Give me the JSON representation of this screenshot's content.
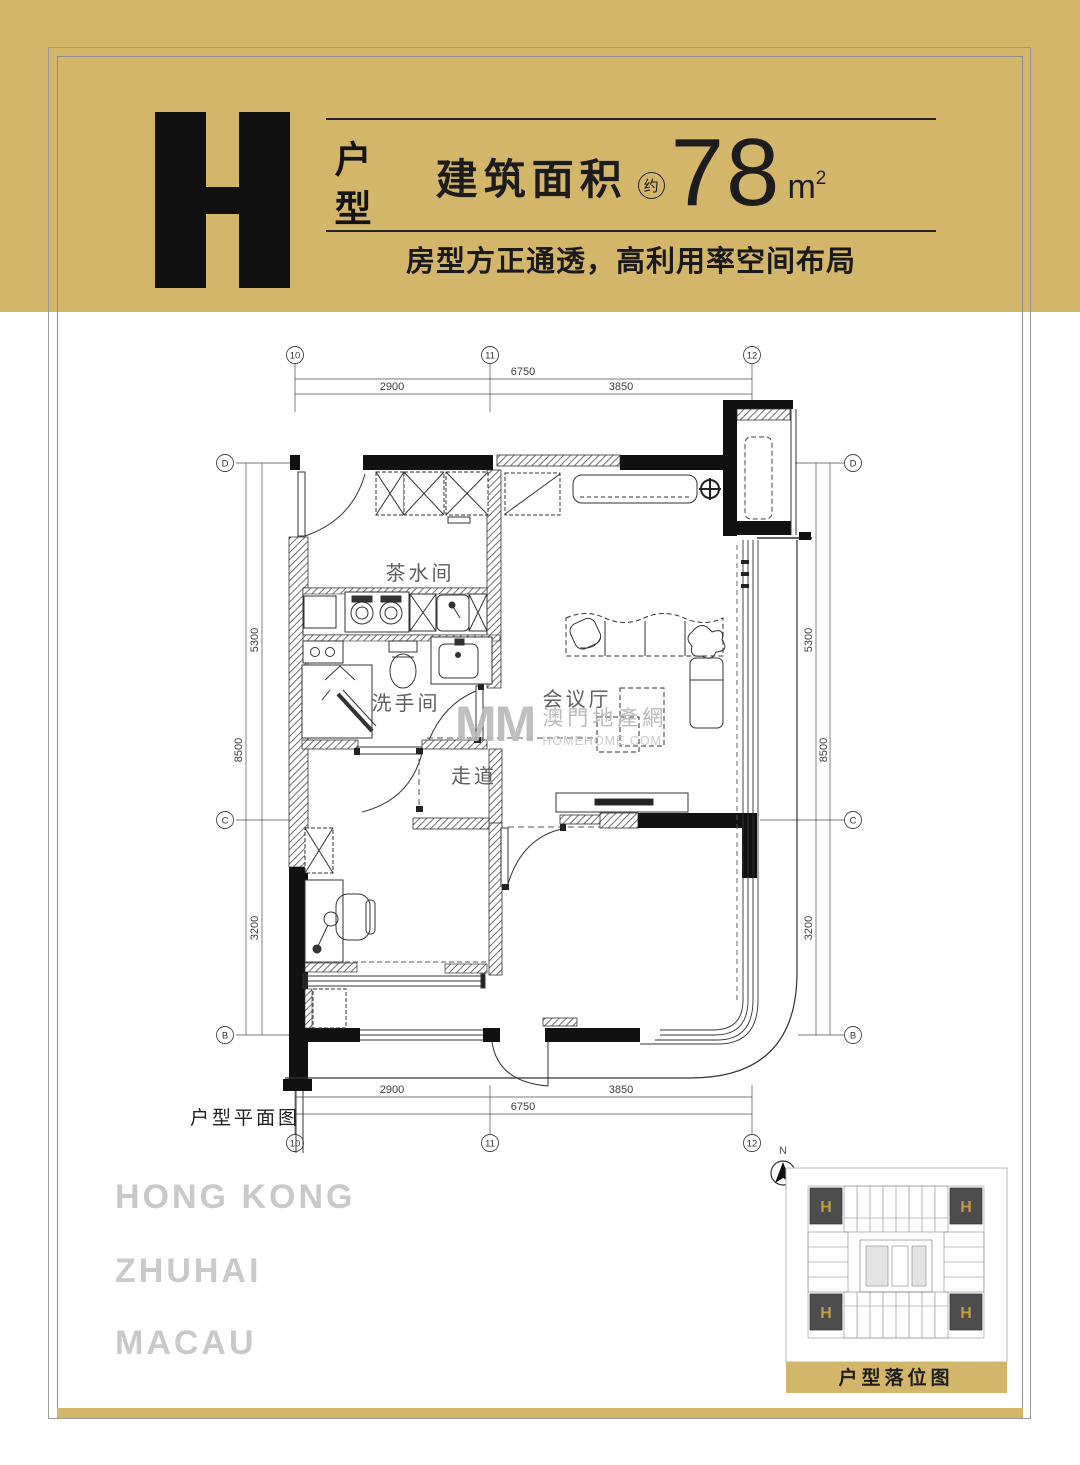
{
  "colors": {
    "gold": "#d3b66a",
    "ink": "#111111",
    "city_gray": "#c9c9c9",
    "watermark_gray": "#b9b9b9",
    "keyplan_unit_fill": "#4d4d4d",
    "keyplan_h_gold": "#c49a3f"
  },
  "header": {
    "unit_letter": "H",
    "unit_type_vertical": "户型",
    "area_label": "建筑面积",
    "area_approx_badge": "约",
    "area_value": "78",
    "area_unit": "m",
    "area_unit_sup": "2",
    "tagline": "房型方正通透，高利用率空间布局"
  },
  "plan": {
    "caption": "户型平面图",
    "grid_columns": [
      "10",
      "11",
      "12"
    ],
    "grid_rows": [
      "D",
      "C",
      "B"
    ],
    "dimensions": {
      "top_total": "6750",
      "span_left": "2900",
      "span_right": "3850",
      "side_total": "8500",
      "side_upper": "5300",
      "side_lower": "3200"
    },
    "rooms": {
      "pantry": "茶水间",
      "washroom": "洗手间",
      "meeting_hall": "会议厅",
      "corridor": "走道"
    }
  },
  "watermark": {
    "logo": "MM",
    "site_name": "澳門地產網",
    "site_domain": "HOMEHOME.COM"
  },
  "footer_cities": [
    "HONG KONG",
    "ZHUHAI",
    "MACAU"
  ],
  "keyplan": {
    "north_label": "N",
    "unit_marker": "H",
    "caption": "户型落位图"
  }
}
